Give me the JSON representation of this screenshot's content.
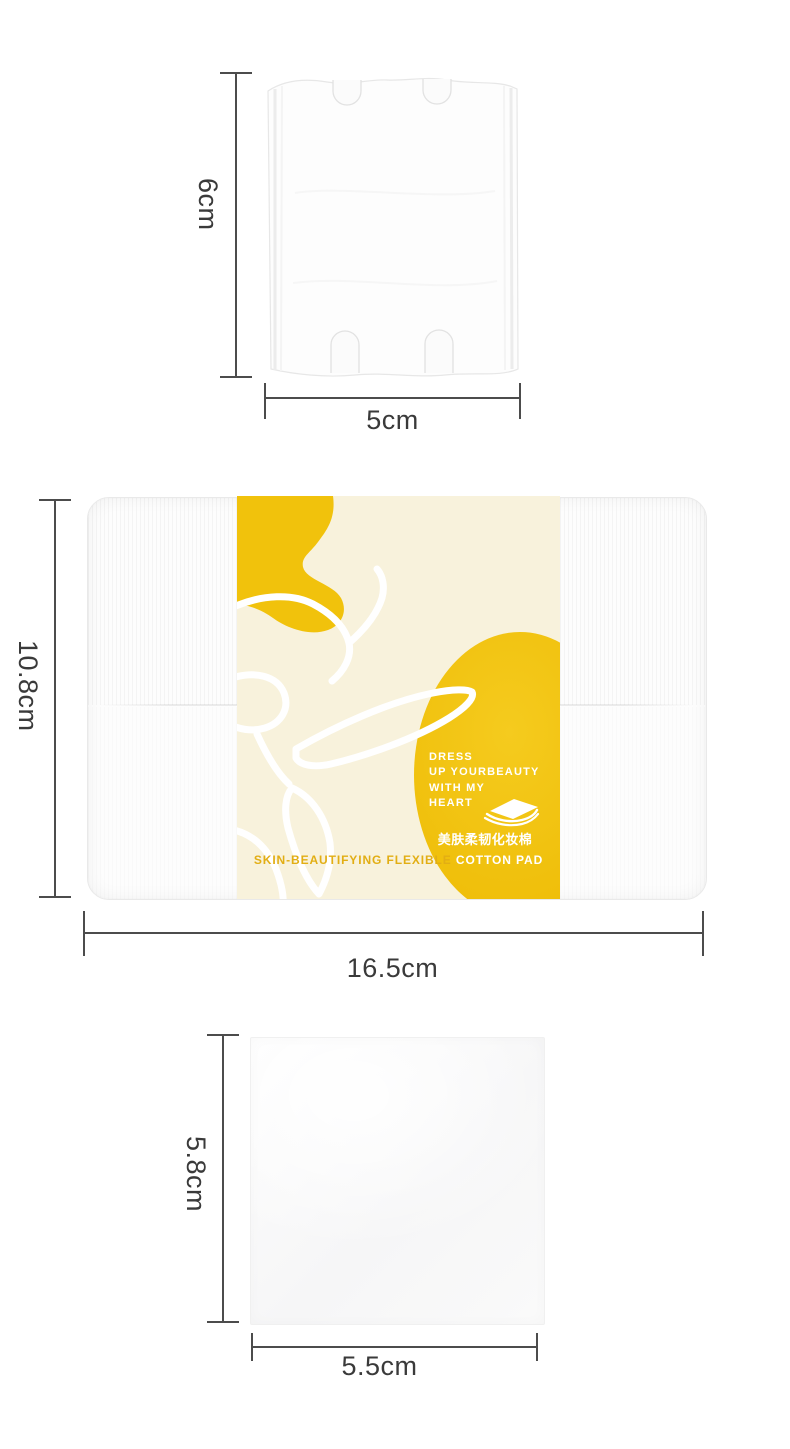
{
  "colors": {
    "yellow": "#F1C20C",
    "yellow_deep": "#EBB90A",
    "cream": "#F8F2DC",
    "gold_text": "#E2AE14",
    "line": "#4C4C4C",
    "ink": "#3A3A3A"
  },
  "top_pad": {
    "height_label": "6cm",
    "width_label": "5cm"
  },
  "package": {
    "height_label": "10.8cm",
    "width_label": "16.5cm",
    "band": {
      "slogan_lines": [
        "DRESS",
        "UP YOURBEAUTY",
        "WITH MY",
        "HEART"
      ],
      "product_name_cn": "美肤柔韧化妆棉",
      "product_name_en_left": "SKIN-BEAUTIFYING FLEXIBLE",
      "product_name_en_right": "COTTON PAD"
    }
  },
  "bottom_pad": {
    "height_label": "5.8cm",
    "width_label": "5.5cm"
  }
}
